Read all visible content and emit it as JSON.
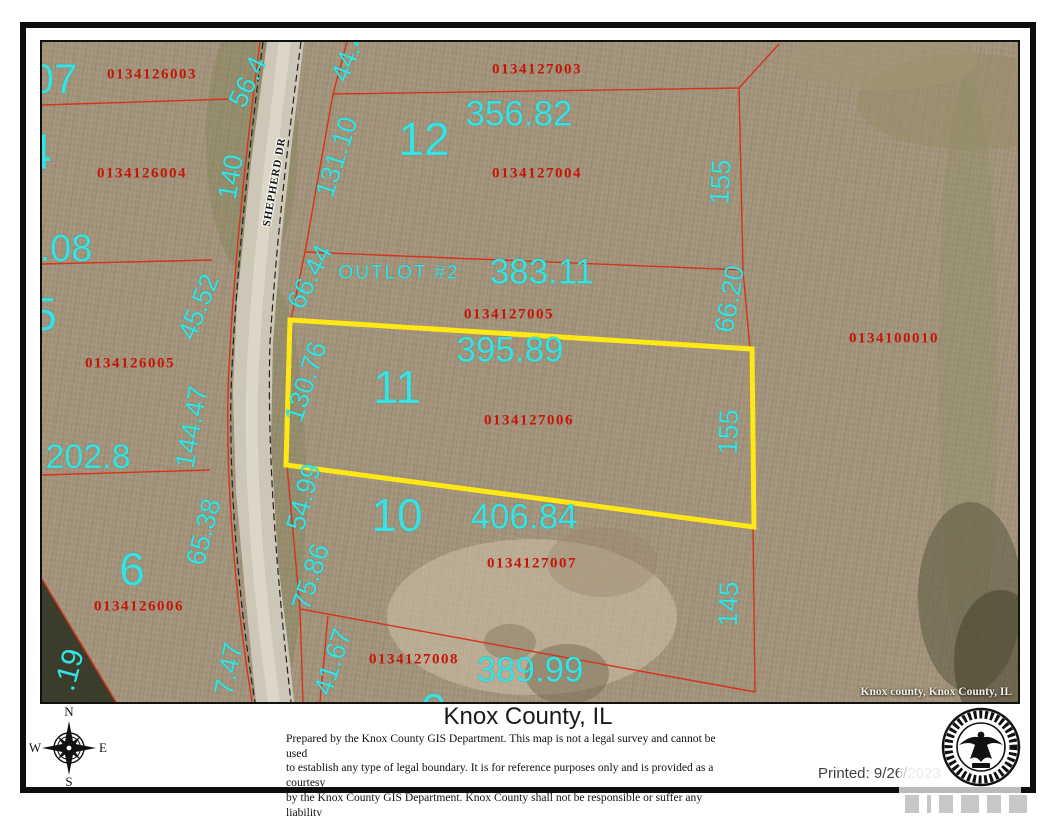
{
  "map": {
    "watermark": "Knox county, Knox County, IL",
    "highlight_color": "#ffe813",
    "boundary_color": "#d63318",
    "dimension_text_color": "#38e2e2",
    "parcel_id_text_color": "#c41508",
    "labels": [
      {
        "cls": "pid",
        "text": "0134126003",
        "x": 110,
        "y": 33,
        "name": "parcel-id-0134126003"
      },
      {
        "cls": "pid",
        "text": "0134127003",
        "x": 495,
        "y": 28,
        "name": "parcel-id-0134127003"
      },
      {
        "cls": "pid",
        "text": "0134126004",
        "x": 100,
        "y": 132,
        "name": "parcel-id-0134126004"
      },
      {
        "cls": "pid",
        "text": "0134127004",
        "x": 495,
        "y": 132,
        "name": "parcel-id-0134127004"
      },
      {
        "cls": "pid",
        "text": "0134127005",
        "x": 467,
        "y": 273,
        "name": "parcel-id-0134127005"
      },
      {
        "cls": "pid",
        "text": "0134126005",
        "x": 88,
        "y": 322,
        "name": "parcel-id-0134126005"
      },
      {
        "cls": "pid",
        "text": "0134100010",
        "x": 852,
        "y": 297,
        "name": "parcel-id-0134100010"
      },
      {
        "cls": "pid",
        "text": "0134127006",
        "x": 487,
        "y": 379,
        "name": "parcel-id-0134127006"
      },
      {
        "cls": "pid",
        "text": "0134127007",
        "x": 490,
        "y": 522,
        "name": "parcel-id-0134127007"
      },
      {
        "cls": "pid",
        "text": "0134126006",
        "x": 97,
        "y": 565,
        "name": "parcel-id-0134126006"
      },
      {
        "cls": "pid",
        "text": "0134127008",
        "x": 372,
        "y": 618,
        "name": "parcel-id-0134127008"
      },
      {
        "cls": "lot",
        "text": "12",
        "x": 382,
        "y": 97,
        "name": "lot-number-12"
      },
      {
        "cls": "lot",
        "text": "11",
        "x": 355,
        "y": 345,
        "name": "lot-number-11"
      },
      {
        "cls": "lot",
        "text": "10",
        "x": 355,
        "y": 473,
        "name": "lot-number-10"
      },
      {
        "cls": "lot",
        "text": "6",
        "x": 90,
        "y": 527,
        "name": "lot-number-6"
      },
      {
        "cls": "lot",
        "text": "9",
        "x": 392,
        "y": 668,
        "name": "lot-number-9-partial"
      },
      {
        "cls": "area",
        "text": "356.82",
        "x": 477,
        "y": 72,
        "name": "dimension-356-82"
      },
      {
        "cls": "area",
        "text": "383.11",
        "x": 500,
        "y": 230,
        "name": "dimension-383-11"
      },
      {
        "cls": "area",
        "text": "395.89",
        "x": 468,
        "y": 308,
        "name": "dimension-395-89"
      },
      {
        "cls": "area",
        "text": "406.84",
        "x": 482,
        "y": 475,
        "name": "dimension-406-84"
      },
      {
        "cls": "area",
        "text": "389.99",
        "x": 488,
        "y": 628,
        "name": "dimension-389-99"
      },
      {
        "cls": "outlot",
        "text": "OUTLOT #2",
        "x": 357,
        "y": 231,
        "name": "outlot-2-label"
      },
      {
        "cls": "edge",
        "text": "07",
        "x": 12,
        "y": 37,
        "size": 42,
        "name": "edge-label-07"
      },
      {
        "cls": "edge",
        "text": "4",
        "x": -4,
        "y": 110,
        "size": 50,
        "name": "edge-label-4"
      },
      {
        "cls": "edge",
        "text": "5",
        "x": 2,
        "y": 272,
        "size": 46,
        "name": "edge-label-5"
      },
      {
        "cls": "edge",
        "text": ".08",
        "x": 24,
        "y": 207,
        "size": 38,
        "name": "edge-label-08"
      },
      {
        "cls": "edge",
        "text": "202.8",
        "x": 46,
        "y": 415,
        "size": 34,
        "name": "dimension-202-8"
      },
      {
        "cls": "edge",
        "text": ".19",
        "x": 28,
        "y": 628,
        "size": 30,
        "rot": -75,
        "name": "edge-label-19"
      },
      {
        "cls": "dim",
        "text": "56.4",
        "x": 206,
        "y": 40,
        "rot": -64,
        "name": "dimension-56-4"
      },
      {
        "cls": "dim",
        "text": "44.4",
        "x": 307,
        "y": 14,
        "rot": -68,
        "name": "dimension-44-4"
      },
      {
        "cls": "dim",
        "text": "131.10",
        "x": 295,
        "y": 115,
        "rot": -72,
        "name": "dimension-131-10"
      },
      {
        "cls": "dim",
        "text": "140",
        "x": 189,
        "y": 135,
        "rot": -80,
        "name": "dimension-140"
      },
      {
        "cls": "dim",
        "text": "155",
        "x": 679,
        "y": 140,
        "rot": -87,
        "name": "dimension-155-top"
      },
      {
        "cls": "dim",
        "text": "66.44",
        "x": 268,
        "y": 235,
        "rot": -63,
        "name": "dimension-66-44"
      },
      {
        "cls": "dim",
        "text": "66.20",
        "x": 688,
        "y": 257,
        "rot": -80,
        "name": "dimension-66-20"
      },
      {
        "cls": "dim",
        "text": "45.52",
        "x": 157,
        "y": 265,
        "rot": -68,
        "name": "dimension-45-52"
      },
      {
        "cls": "dim",
        "text": "130.76",
        "x": 264,
        "y": 340,
        "rot": -72,
        "name": "dimension-130-76"
      },
      {
        "cls": "dim",
        "text": "144.47",
        "x": 150,
        "y": 385,
        "rot": -80,
        "name": "dimension-144-47"
      },
      {
        "cls": "dim",
        "text": "155",
        "x": 687,
        "y": 390,
        "rot": -88,
        "name": "dimension-155-mid"
      },
      {
        "cls": "dim",
        "text": "54.99",
        "x": 262,
        "y": 455,
        "rot": -75,
        "name": "dimension-54-99"
      },
      {
        "cls": "dim",
        "text": "65.38",
        "x": 162,
        "y": 490,
        "rot": -75,
        "name": "dimension-65-38"
      },
      {
        "cls": "dim",
        "text": "75.86",
        "x": 269,
        "y": 535,
        "rot": -72,
        "name": "dimension-75-86"
      },
      {
        "cls": "dim",
        "text": "145",
        "x": 687,
        "y": 562,
        "rot": -88,
        "name": "dimension-145"
      },
      {
        "cls": "dim",
        "text": "41.67",
        "x": 291,
        "y": 620,
        "rot": -72,
        "name": "dimension-41-67"
      },
      {
        "cls": "dim",
        "text": "7.47",
        "x": 187,
        "y": 627,
        "rot": -78,
        "name": "dimension-7-47"
      },
      {
        "cls": "road",
        "text": "SHEPHERD DR",
        "x": 233,
        "y": 140,
        "rot": -80,
        "name": "road-label-shepherd-dr"
      }
    ]
  },
  "footer": {
    "title": "Knox County, IL",
    "disclaimer_lines": [
      "Prepared by the Knox County GIS Department. This map is not a legal survey and cannot be used",
      "to establish any type of legal boundary. It is for reference purposes only and is provided as a courtesy",
      "by the Knox County GIS Department.  Knox County shall not be responsible or suffer any liability",
      "for any decisions or interpretations of any kind made by any party using this map or attribute data."
    ],
    "printed_label": "Printed: 9/26/",
    "printed_faded": "2023",
    "compass": {
      "n": "N",
      "e": "E",
      "s": "S",
      "w": "W"
    }
  }
}
